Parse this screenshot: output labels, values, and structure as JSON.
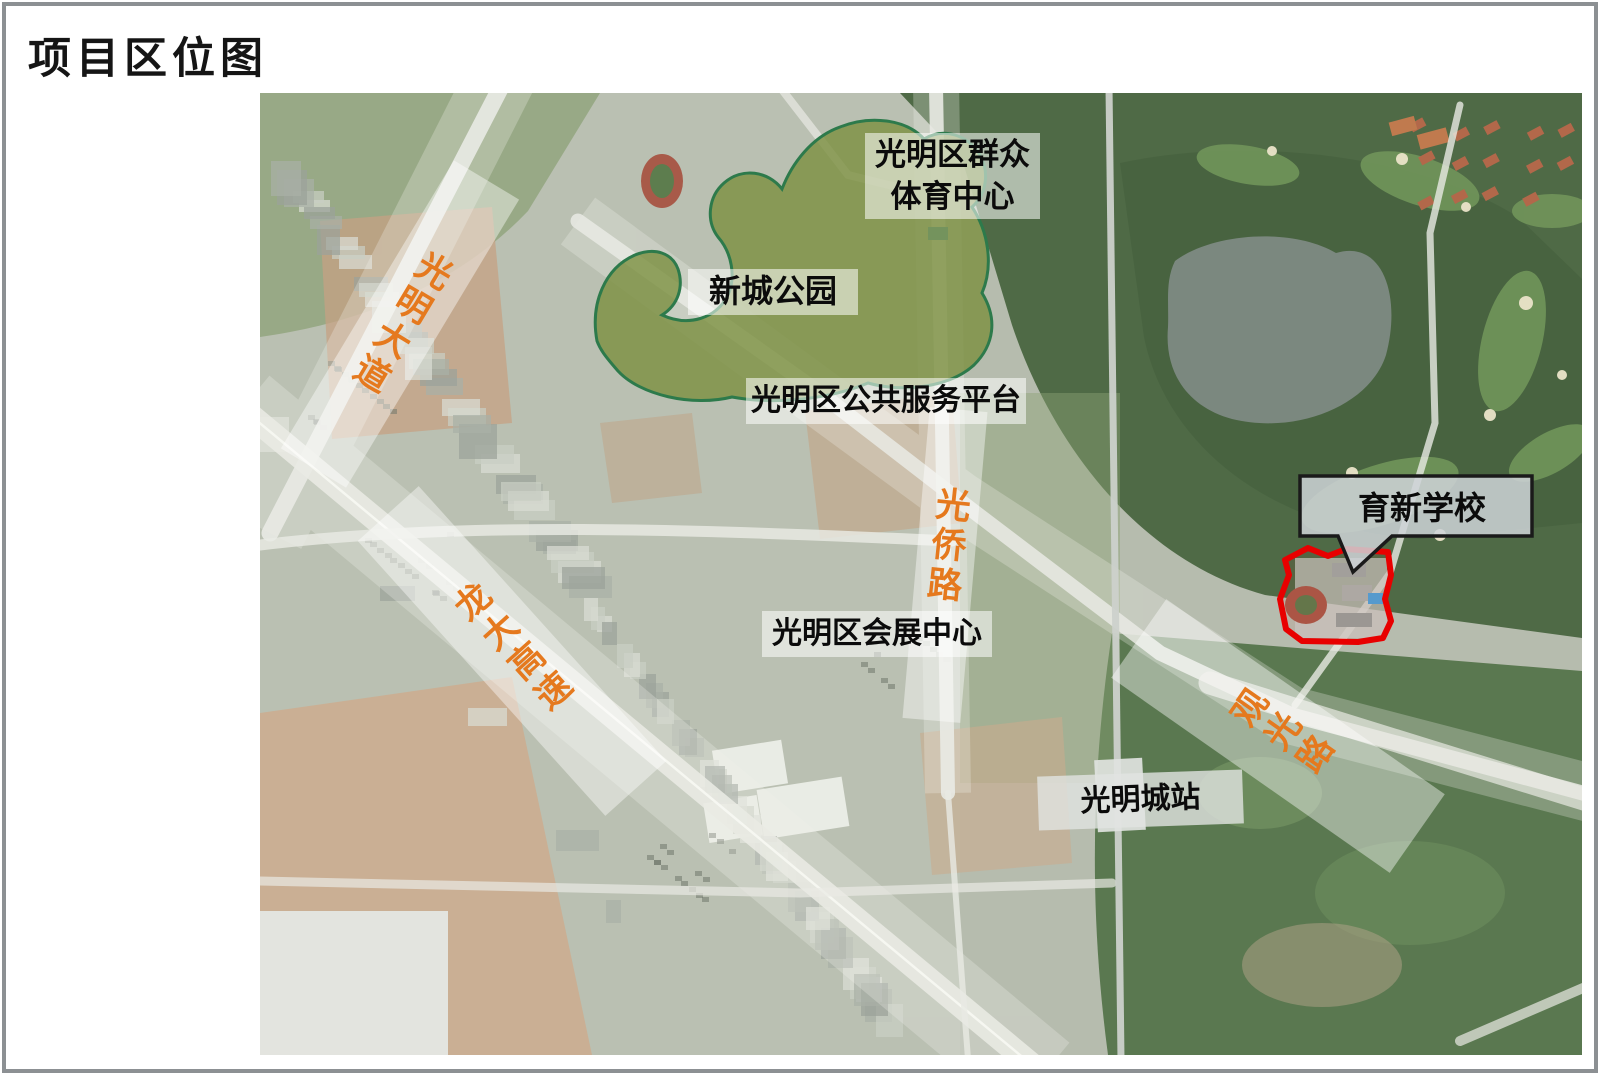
{
  "title": "项目区位图",
  "map": {
    "place_labels": {
      "sports_center": {
        "line1": "光明区群众",
        "line2": "体育中心"
      },
      "park": "新城公园",
      "service_platform": "光明区公共服务平台",
      "convention_center": "光明区会展中心",
      "station": "光明城站"
    },
    "road_labels": {
      "guangming_avenue": "光明大道",
      "longda_expressway": "龙大高速",
      "guangqiao_road": "光侨路",
      "guanguang_road": "观光路"
    },
    "callout": {
      "school": "育新学校"
    },
    "colors": {
      "road_label_text": "#E5791E",
      "park_fill": "#7C9042",
      "park_outline": "#2D7A4B",
      "site_outline": "#E80000",
      "label_background": "rgba(255,255,255,0.55)"
    }
  }
}
